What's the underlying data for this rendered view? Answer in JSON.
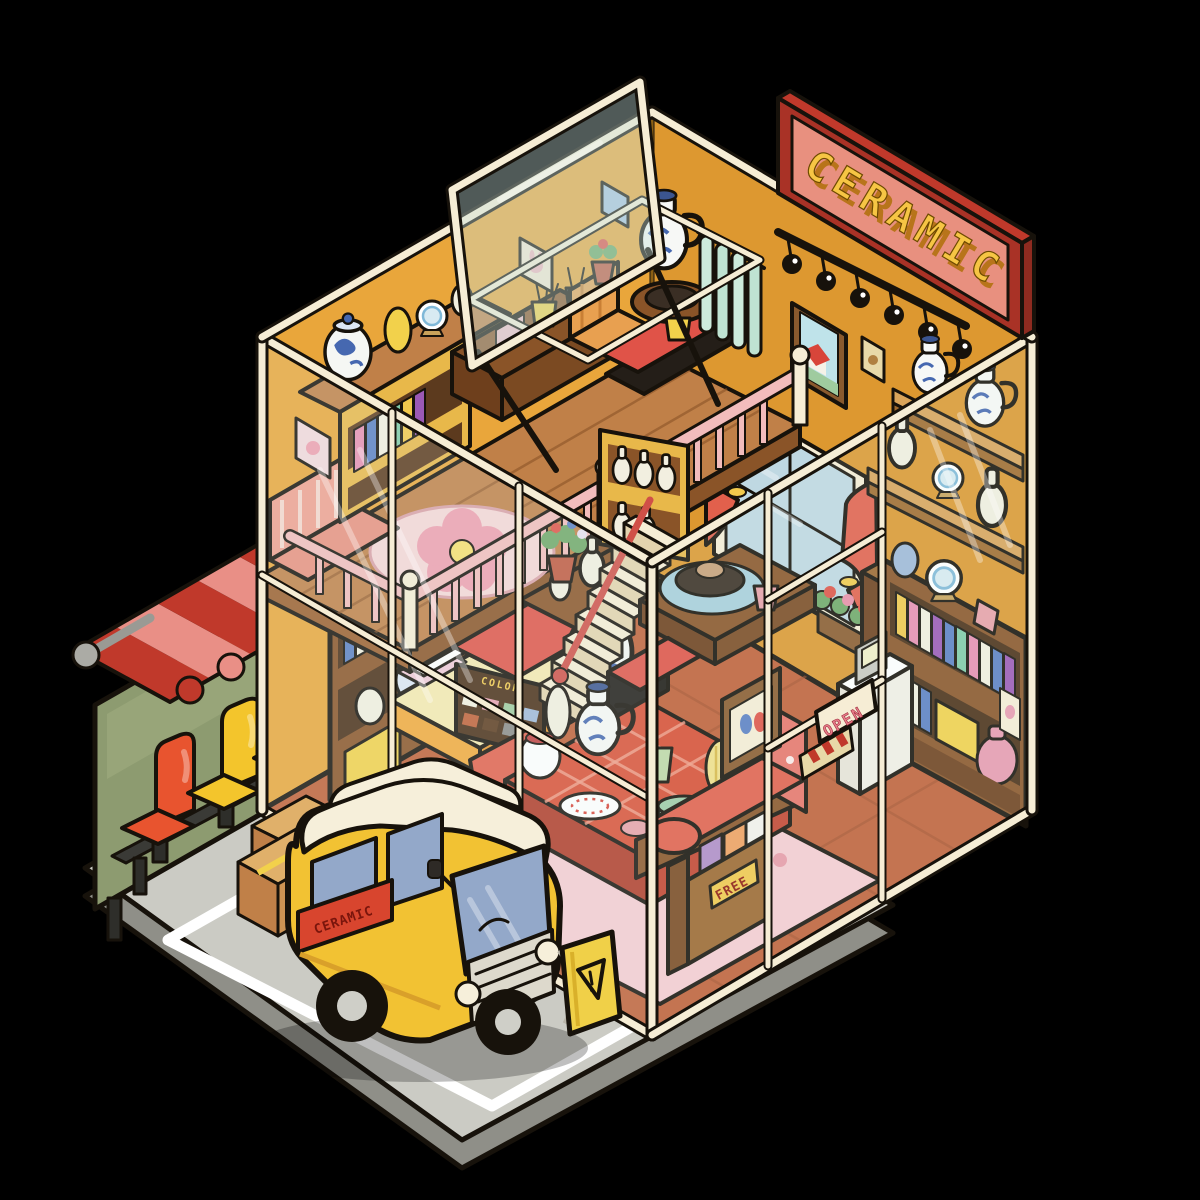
{
  "scene": {
    "description": "Cartoon isometric cutaway illustration of a two-story ceramic pottery shop with glass walls, a loft, a delivery van parked outside, a bus-stop bench with striped awning, and shelves full of blue-and-white ceramics",
    "background_color": "#000000"
  },
  "signs": {
    "shop_sign": "CERAMIC",
    "van_banner": "CERAMIC",
    "door_sign": "OPEN",
    "free_label": "FREE",
    "reserve_banner": "RESERVE",
    "glaze_machine_label": "COLOR"
  },
  "icons": {
    "caution_sign": "warning-triangle"
  },
  "palette": {
    "wall_yellow": "#E9A63B",
    "wall_yellow_dark": "#DD9830",
    "frame_cream": "#F6EDD5",
    "outline": "#17120B",
    "sign_frame_red": "#A93226",
    "sign_face_pink": "#E8907F",
    "sign_letter_gold": "#F2C94C",
    "awning_red": "#C0392B",
    "awning_pink": "#E98F86",
    "seat_red": "#E8542F",
    "seat_yellow": "#F3C52C",
    "seat_teal": "#3FC596",
    "van_yellow": "#F2C233",
    "van_roof_cream": "#F6EFDA",
    "window_blue": "#93A8C9",
    "floor_terracotta": "#C06038",
    "loft_wood": "#C08048",
    "railing_pink": "#F2BCBC",
    "sofa_red": "#E2604C",
    "rug_pink": "#F6CCD2",
    "platform_gray": "#CBCBC4",
    "ceramic_blue": "#4668B0",
    "caution_yellow": "#F0D048"
  },
  "inventory": [
    "ceramic shop sign",
    "track lighting",
    "open skylight window",
    "wall shelves with blue-and-white ceramics",
    "bookshelves with pottery",
    "glass door with open sign",
    "cash register kiosk",
    "window with red curtains",
    "flower planter",
    "display table with vases and plates",
    "floral sofa",
    "free magazine rack",
    "pink flower rug",
    "pottery wheel station",
    "staircase with red handrail",
    "glaze color machine",
    "reserve display table",
    "loft with pink railing and flower rug",
    "work desk with brush cups",
    "bus stop awning",
    "bus stop bucket seats",
    "yellow delivery van",
    "caution floor sign",
    "cardboard boxes",
    "parking bay"
  ]
}
